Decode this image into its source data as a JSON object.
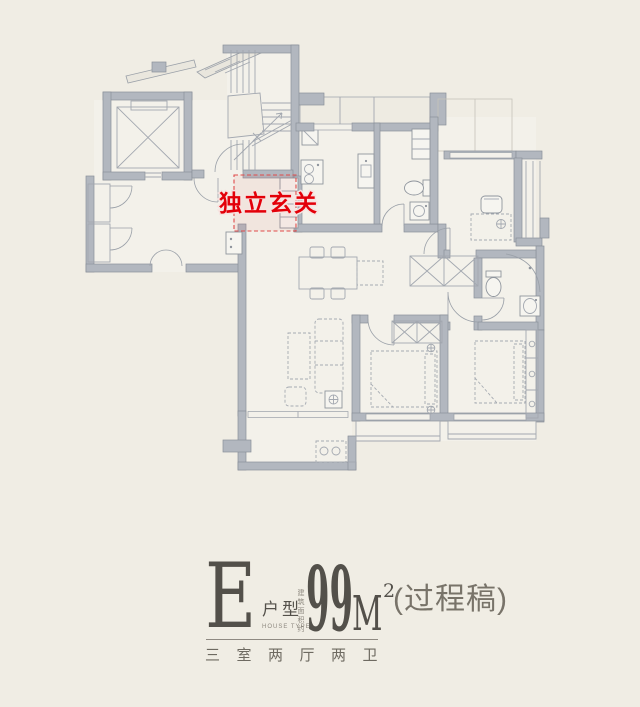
{
  "page": {
    "background": "#f0ede4"
  },
  "floor_plan": {
    "highlight": {
      "label": "独立玄关",
      "color": "#e30009"
    },
    "colors": {
      "wall": "#b2b7bf",
      "line": "#9aa0a8",
      "floor": "#f3f1ea",
      "background": "#f0ede4"
    }
  },
  "caption": {
    "unit_letter": "E",
    "unit_label": "户型",
    "unit_label_en": "HOUSE TYPE",
    "area_note": "建筑面积约",
    "area_value": "99",
    "area_unit": "M",
    "area_sup": "2",
    "draft_note": "(过程稿)",
    "layout_summary": "三室两厅两卫",
    "text_color": "#53504a",
    "muted_color": "#8d887f"
  }
}
